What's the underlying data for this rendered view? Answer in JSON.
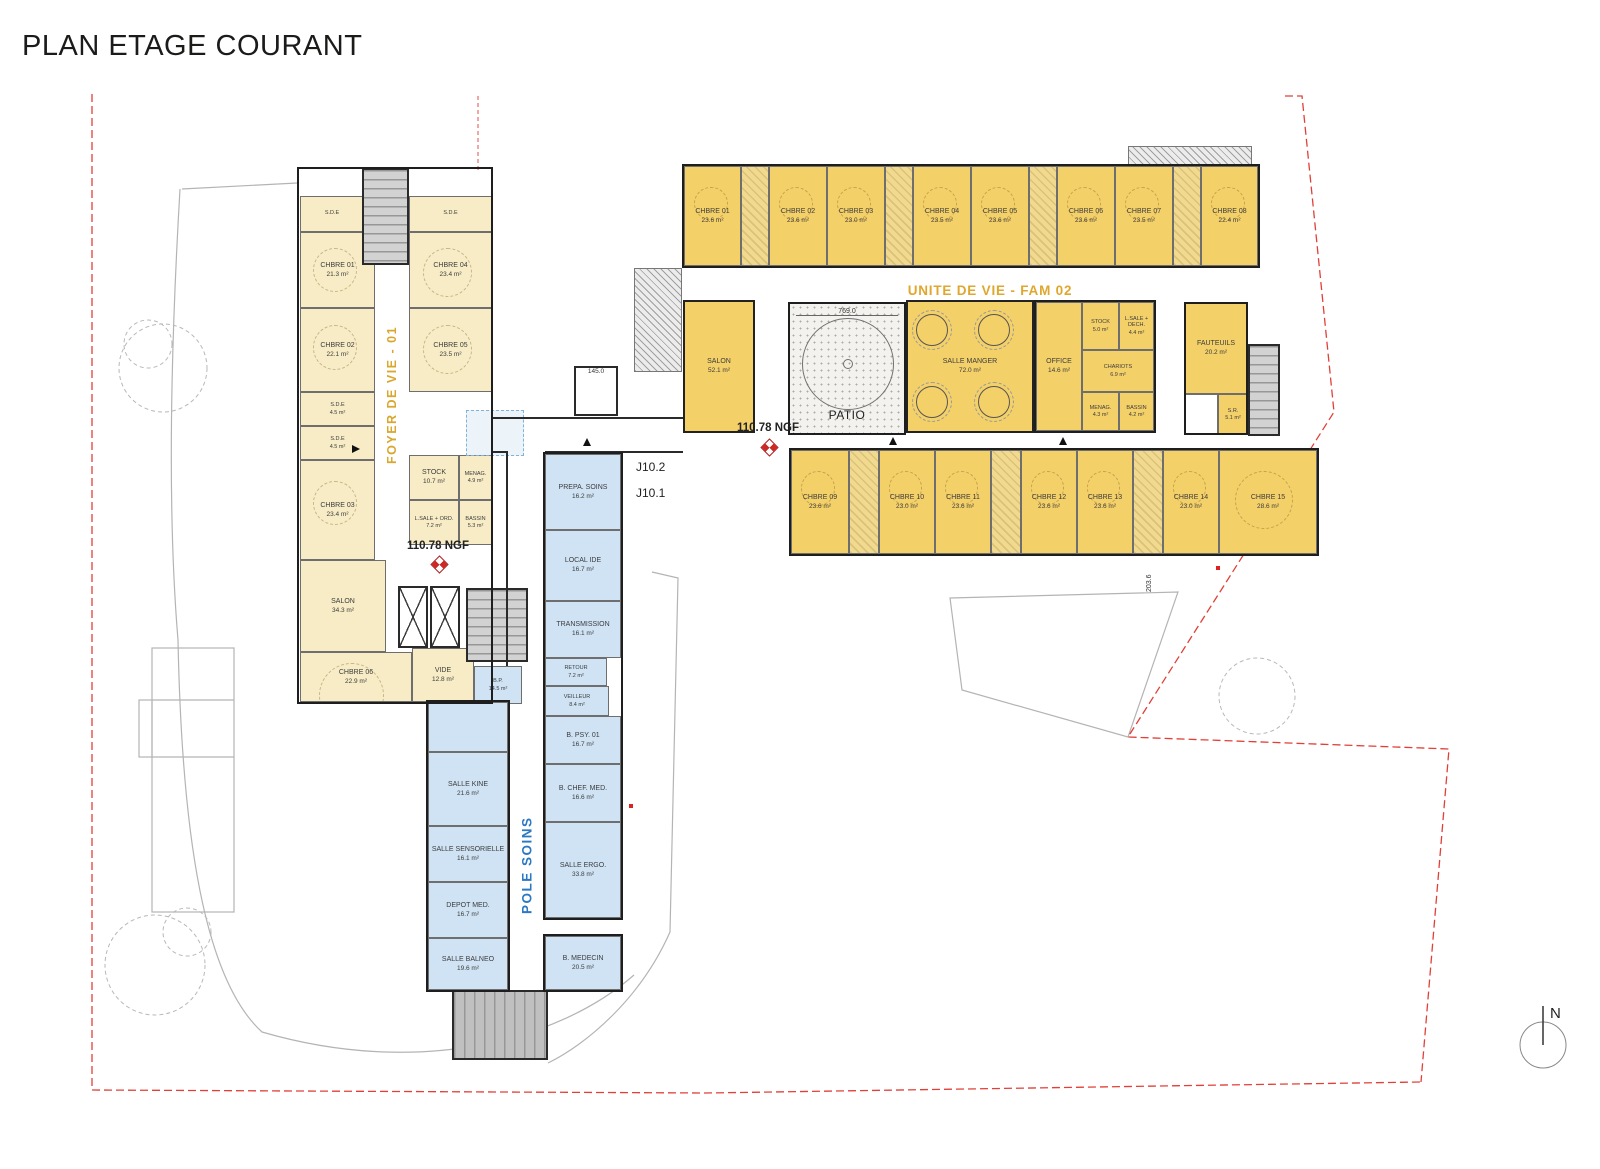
{
  "title": "PLAN ETAGE COURANT",
  "foyer": {
    "label": "FOYER DE VIE - 01",
    "rooms": [
      {
        "name": "S.D.E",
        "area": ""
      },
      {
        "name": "S.D.E",
        "area": ""
      },
      {
        "name": "CHBRE 01",
        "area": "21.3 m²"
      },
      {
        "name": "CHBRE 04",
        "area": "23.4 m²"
      },
      {
        "name": "CHBRE 02",
        "area": "22.1 m²"
      },
      {
        "name": "CHBRE 05",
        "area": "23.5 m²"
      },
      {
        "name": "S.D.E",
        "area": "4.5 m²"
      },
      {
        "name": "S.D.E",
        "area": "4.5 m²"
      },
      {
        "name": "CHBRE 03",
        "area": "23.4 m²"
      },
      {
        "name": "STOCK",
        "area": "10.7 m²"
      },
      {
        "name": "MENAG.",
        "area": "4.9 m²"
      },
      {
        "name": "L.SALE + ORD.",
        "area": "7.2 m²"
      },
      {
        "name": "BASSIN",
        "area": "5.3 m²"
      },
      {
        "name": "SALON",
        "area": "34.3 m²"
      },
      {
        "name": "CHBRE 06",
        "area": "22.9 m²"
      },
      {
        "name": "VIDE",
        "area": "12.8 m²"
      },
      {
        "name": "B.P.",
        "area": "14.5 m²"
      }
    ]
  },
  "unite": {
    "label": "UNITE DE VIE - FAM 02",
    "patio_label": "PATIO",
    "patio_dim": "769.0",
    "top": [
      {
        "name": "CHBRE 01",
        "area": "23.6 m²"
      },
      {
        "name": "CHBRE 02",
        "area": "23.6 m²"
      },
      {
        "name": "CHBRE 03",
        "area": "23.0 m²"
      },
      {
        "name": "CHBRE 04",
        "area": "23.5 m²"
      },
      {
        "name": "CHBRE 05",
        "area": "23.6 m²"
      },
      {
        "name": "CHBRE 06",
        "area": "23.6 m²"
      },
      {
        "name": "CHBRE 07",
        "area": "23.5 m²"
      },
      {
        "name": "CHBRE 08",
        "area": "22.4 m²"
      }
    ],
    "bottom": [
      {
        "name": "CHBRE 09",
        "area": "23.6 m²"
      },
      {
        "name": "CHBRE 10",
        "area": "23.0 m²"
      },
      {
        "name": "CHBRE 11",
        "area": "23.6 m²"
      },
      {
        "name": "CHBRE 12",
        "area": "23.6 m²"
      },
      {
        "name": "CHBRE 13",
        "area": "23.6 m²"
      },
      {
        "name": "CHBRE 14",
        "area": "23.0 m²"
      },
      {
        "name": "CHBRE 15",
        "area": "28.6 m²"
      }
    ],
    "core": [
      {
        "name": "SALON",
        "area": "52.1 m²"
      },
      {
        "name": "SALLE MANGER",
        "area": "72.0 m²"
      },
      {
        "name": "OFFICE",
        "area": "14.6 m²"
      },
      {
        "name": "STOCK",
        "area": "5.0 m²"
      },
      {
        "name": "L.SALE + DECH.",
        "area": "4.4 m²"
      },
      {
        "name": "CHARIOTS",
        "area": "6.9 m²"
      },
      {
        "name": "MENAG.",
        "area": "4.3 m²"
      },
      {
        "name": "BASSIN",
        "area": "4.2 m²"
      },
      {
        "name": "FAUTEUILS",
        "area": "20.2 m²"
      },
      {
        "name": "S.R.",
        "area": "5.1 m²"
      }
    ]
  },
  "pole": {
    "label": "POLE SOINS",
    "rooms": [
      {
        "name": "PREPA. SOINS",
        "area": "16.2 m²"
      },
      {
        "name": "LOCAL IDE",
        "area": "16.7 m²"
      },
      {
        "name": "TRANSMISSION",
        "area": "16.1 m²"
      },
      {
        "name": "RETOUR",
        "area": "7.2 m²"
      },
      {
        "name": "VEILLEUR",
        "area": "8.4 m²"
      },
      {
        "name": "B. PSY. 01",
        "area": "16.7 m²"
      },
      {
        "name": "B. CHEF. MED.",
        "area": "16.6 m²"
      },
      {
        "name": "SALLE ERGO.",
        "area": "33.8 m²"
      },
      {
        "name": "B. MEDECIN",
        "area": "20.5 m²"
      },
      {
        "name": "SALLE KINE",
        "area": "21.6 m²"
      },
      {
        "name": "SALLE SENSORIELLE",
        "area": "16.1 m²"
      },
      {
        "name": "DEPOT MED.",
        "area": "16.7 m²"
      },
      {
        "name": "SALLE BALNEO",
        "area": "19.6 m²"
      }
    ]
  },
  "annotations": {
    "ngf_left": "110.78 NGF",
    "ngf_right": "110.78 NGF",
    "grid_1": "J10.2",
    "grid_2": "J10.1",
    "dim_right": "203.6",
    "lift_dim": "145.0",
    "north": "N"
  }
}
